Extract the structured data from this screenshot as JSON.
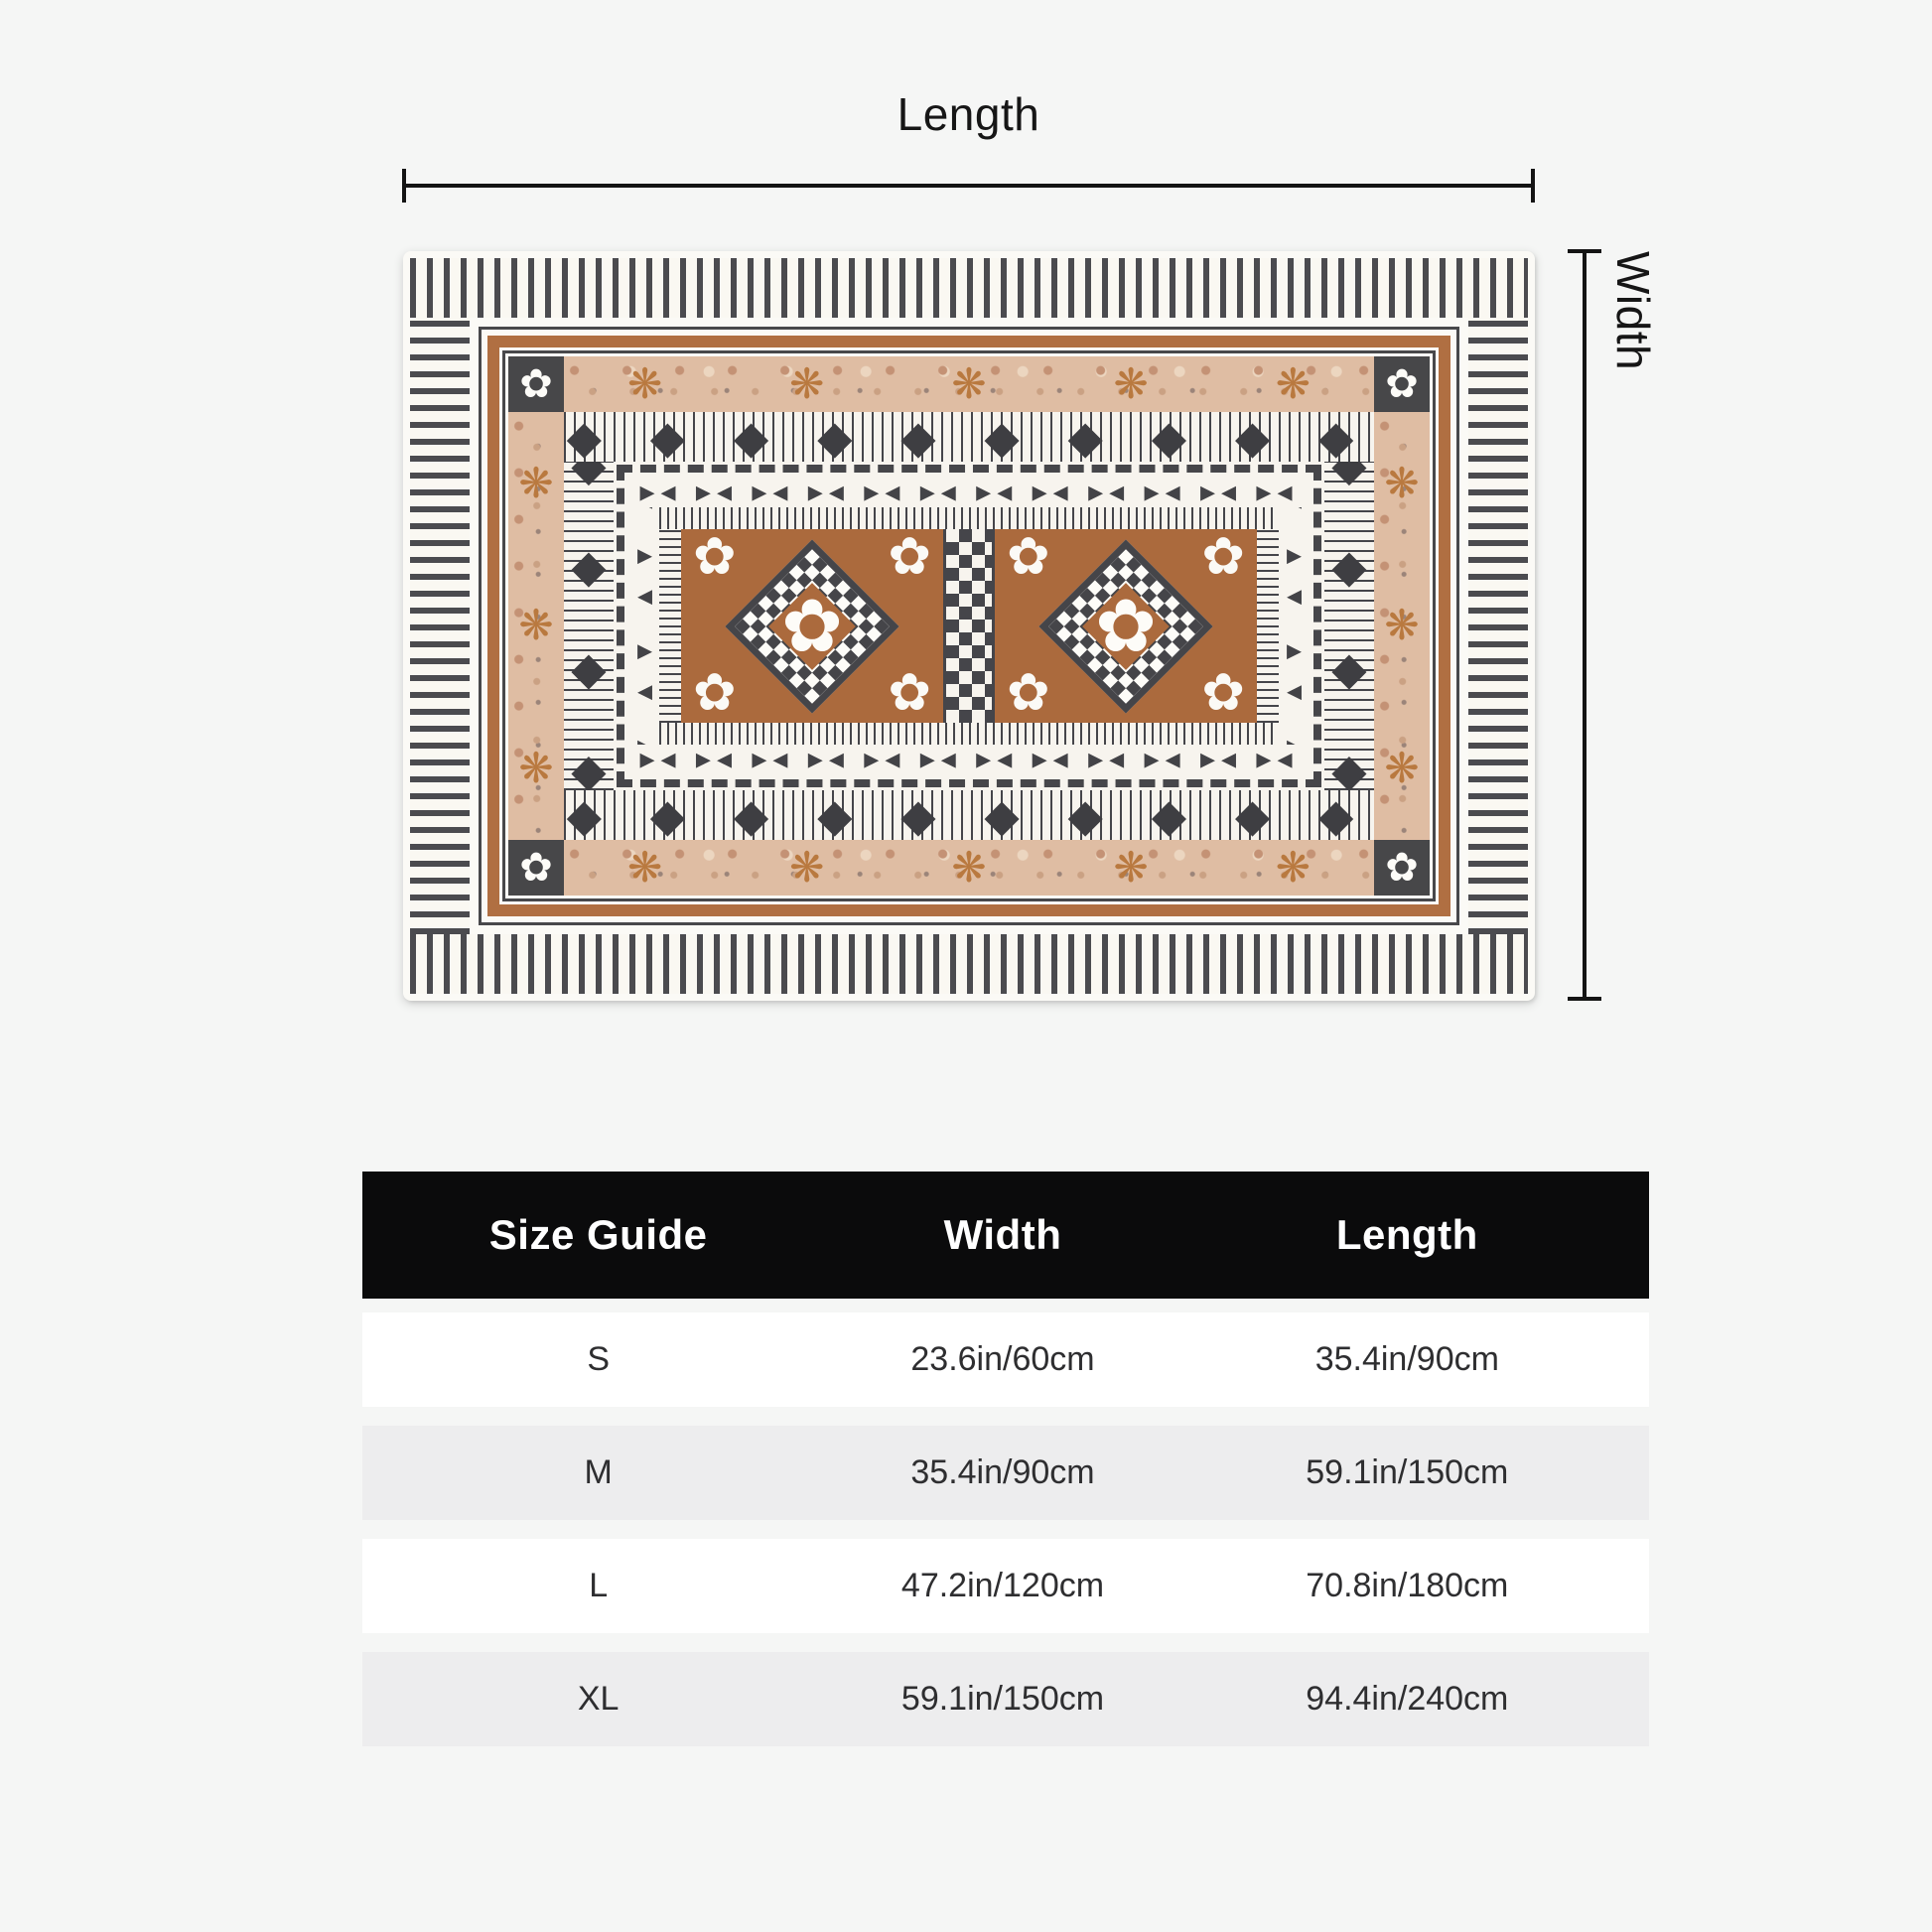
{
  "page": {
    "background": "#f5f6f5"
  },
  "diagram": {
    "length_label": "Length",
    "width_label": "Width"
  },
  "rug": {
    "description": "Fijian masi tapa-style rectangular rug with charcoal, white, tan and brown geometric borders, two diamond medallions with white flowers and a central triangle strip",
    "colors": {
      "field_brown": "#ab6a3d",
      "accent_brown": "#b06f42",
      "charcoal": "#454549",
      "mottled_tan": "#dfbda3",
      "off_white": "#f7f4ee"
    },
    "glyphs": {
      "diamond": "◆",
      "bowtie": "▸◂",
      "star": "❋",
      "flower": "✿",
      "corner_flower": "✿"
    }
  },
  "size_table": {
    "header_bg": "#0b0b0c",
    "row_alt_bg": "#ededee",
    "headers": [
      "Size Guide",
      "Width",
      "Length"
    ],
    "rows": [
      {
        "size": "S",
        "width": "23.6in/60cm",
        "length": "35.4in/90cm"
      },
      {
        "size": "M",
        "width": "35.4in/90cm",
        "length": "59.1in/150cm"
      },
      {
        "size": "L",
        "width": "47.2in/120cm",
        "length": "70.8in/180cm"
      },
      {
        "size": "XL",
        "width": "59.1in/150cm",
        "length": "94.4in/240cm"
      }
    ]
  }
}
